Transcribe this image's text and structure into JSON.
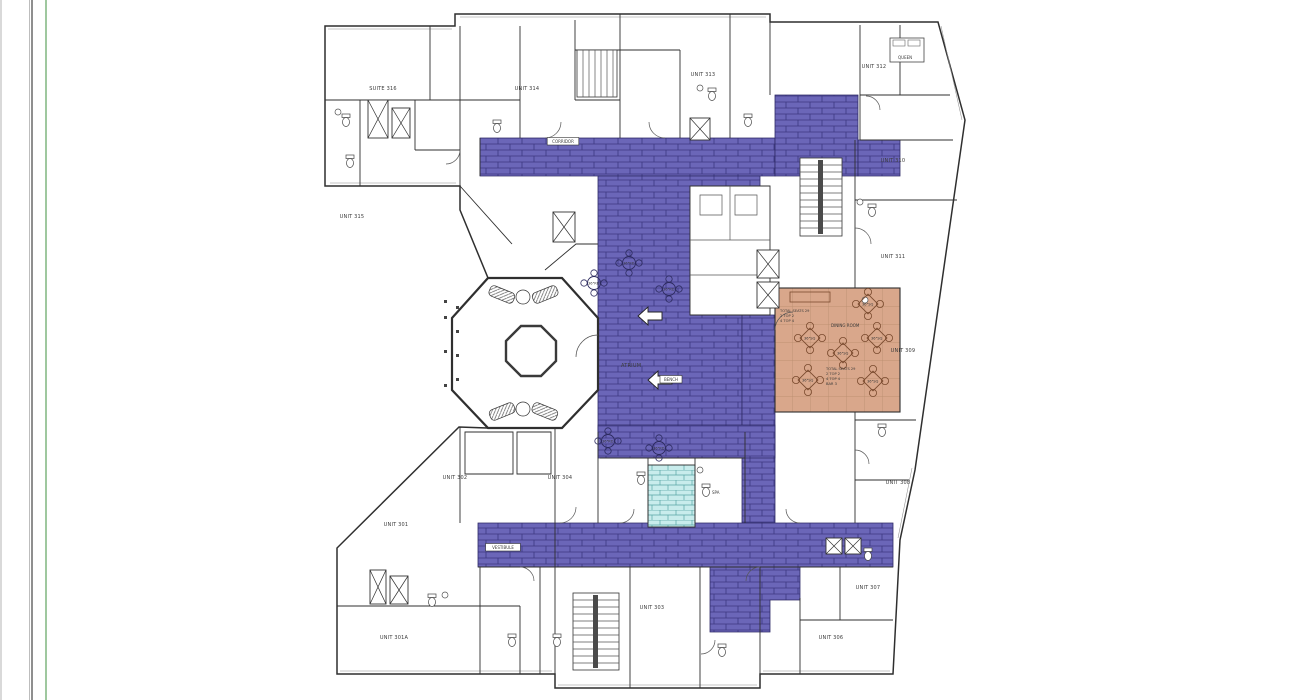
{
  "sheet": {
    "background": "#ffffff",
    "left_border_gray": "#8f8f8f",
    "left_border_green": "#9fc89f",
    "left_edge_shadow": "#d9d9d9"
  },
  "colors": {
    "corridor_fill": "#6b66b8",
    "corridor_line": "#3c3780",
    "dining_fill": "#d9a78b",
    "dining_line": "#b68a6a",
    "dining_glyph": "#7b4b2f",
    "spa_fill": "#c8ecec",
    "spa_line": "#58a5a5",
    "wall": "#2f2f2f"
  },
  "labels": {
    "atrium": "ATRIUM",
    "dining_room": "DINING ROOM",
    "spa": "SPA",
    "queen": "QUEEN",
    "table_square": "36\"SQ",
    "table_round": "36\"RD"
  },
  "boxed_labels": [
    {
      "label": "CORRIDOR",
      "x": 563,
      "y": 143
    },
    {
      "label": "VESTIBULE",
      "x": 503,
      "y": 549
    },
    {
      "label": "BENCH",
      "x": 671,
      "y": 381
    }
  ],
  "dining": {
    "seating_note_top": [
      "TOTAL SEATS 29",
      "2 TOP 2",
      "4 TOP 4"
    ],
    "seating_note_bottom": [
      "TOTAL SEATS 29",
      "2 TOP 2",
      "4 TOP 4",
      "BAR 3"
    ]
  },
  "units": [
    {
      "label": "SUITE 316",
      "x": 383,
      "y": 90
    },
    {
      "label": "UNIT 314",
      "x": 527,
      "y": 90
    },
    {
      "label": "UNIT 313",
      "x": 703,
      "y": 76
    },
    {
      "label": "UNIT 312",
      "x": 874,
      "y": 68
    },
    {
      "label": "UNIT 315",
      "x": 352,
      "y": 218
    },
    {
      "label": "UNIT 310",
      "x": 893,
      "y": 162
    },
    {
      "label": "UNIT 311",
      "x": 893,
      "y": 258
    },
    {
      "label": "UNIT 309",
      "x": 903,
      "y": 352
    },
    {
      "label": "UNIT 308",
      "x": 898,
      "y": 484
    },
    {
      "label": "UNIT 307",
      "x": 868,
      "y": 589
    },
    {
      "label": "UNIT 306",
      "x": 831,
      "y": 639
    },
    {
      "label": "UNIT 303",
      "x": 652,
      "y": 609
    },
    {
      "label": "UNIT 304",
      "x": 560,
      "y": 479
    },
    {
      "label": "UNIT 302",
      "x": 455,
      "y": 479
    },
    {
      "label": "UNIT 301",
      "x": 396,
      "y": 526
    },
    {
      "label": "UNIT 301A",
      "x": 394,
      "y": 639
    }
  ],
  "square_tables": [
    {
      "x": 868,
      "y": 304
    },
    {
      "x": 810,
      "y": 338
    },
    {
      "x": 877,
      "y": 338
    },
    {
      "x": 843,
      "y": 353
    },
    {
      "x": 808,
      "y": 380
    },
    {
      "x": 873,
      "y": 381
    }
  ],
  "round_tables": [
    {
      "x": 629,
      "y": 263
    },
    {
      "x": 594,
      "y": 283
    },
    {
      "x": 669,
      "y": 289
    },
    {
      "x": 608,
      "y": 441
    },
    {
      "x": 659,
      "y": 448
    }
  ],
  "icons": {
    "stair": "stair-icon",
    "elevator": "elevator-x-icon",
    "toilet": "toilet-icon",
    "sink": "sink-icon",
    "door_swing": "door-swing-icon",
    "direction_arrow": "direction-arrow-icon",
    "sofa": "sofa-icon",
    "bed": "bed-icon"
  }
}
